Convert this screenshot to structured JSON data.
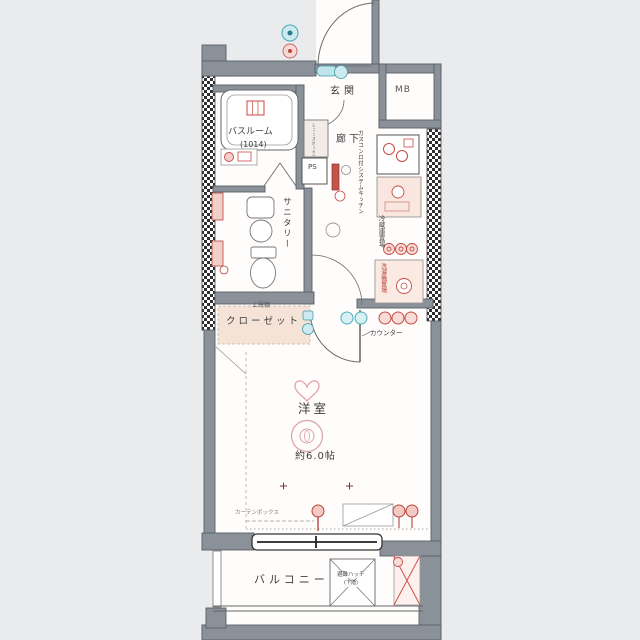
{
  "floorplan": {
    "labels": {
      "genkan": "玄関",
      "mb": "MB",
      "bathroom": "バスルーム",
      "bathroom_size": "(1014)",
      "hallway": "廊下",
      "ps": "PS",
      "shoebox": "シューズボックス",
      "sanitary": "サニタリー",
      "kitchen": "ガスコンロ付システムキッチン",
      "fridge": "冷蔵庫置場",
      "washer": "洗濯機置場",
      "closet": "クローゼット",
      "closet_shelf": "上段棚",
      "counter": "カウンター",
      "room": "洋室",
      "room_size": "約6.0帖",
      "curtain_box": "カーテンボックス",
      "balcony": "バルコニー",
      "hatch": "避難ハッチ",
      "hatch_floor": "(下階)"
    },
    "colors": {
      "background": "#e9ebed",
      "paper": "#fffdfc",
      "wall": "#8b9199",
      "accent_red": "#c84a42",
      "accent_teal": "#49b0bf",
      "closet_fill": "#f6e3d7"
    }
  }
}
